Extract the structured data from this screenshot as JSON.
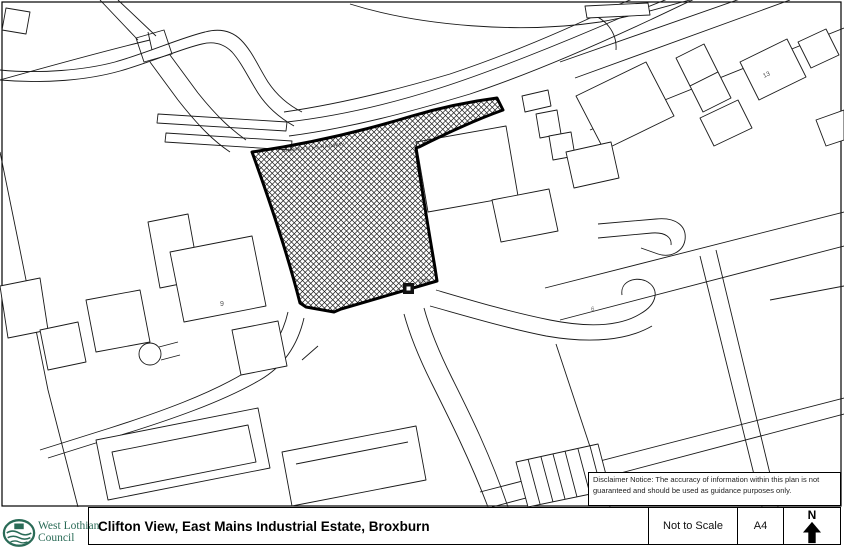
{
  "document": {
    "title": "Clifton View, East Mains Industrial Estate, Broxburn",
    "scale_note": "Not to Scale",
    "paper_size": "A4",
    "north_label": "N",
    "disclaimer": "Disclaimer Notice: The accuracy of information within this plan is not guaranteed and should be used as guidance purposes only."
  },
  "logo": {
    "org_line1": "West Lothian",
    "org_line2": "Council",
    "brand_color": "#2a6b57"
  },
  "map": {
    "labels": {
      "railway": "DISMANTLED RAILWAY",
      "building_9": "9",
      "building_13": "13",
      "building_6": "6",
      "substation": "ESS"
    },
    "line_color": "#1a1a1a",
    "site_outline_color": "#000000",
    "site_fill_style": "black crosshatch"
  }
}
